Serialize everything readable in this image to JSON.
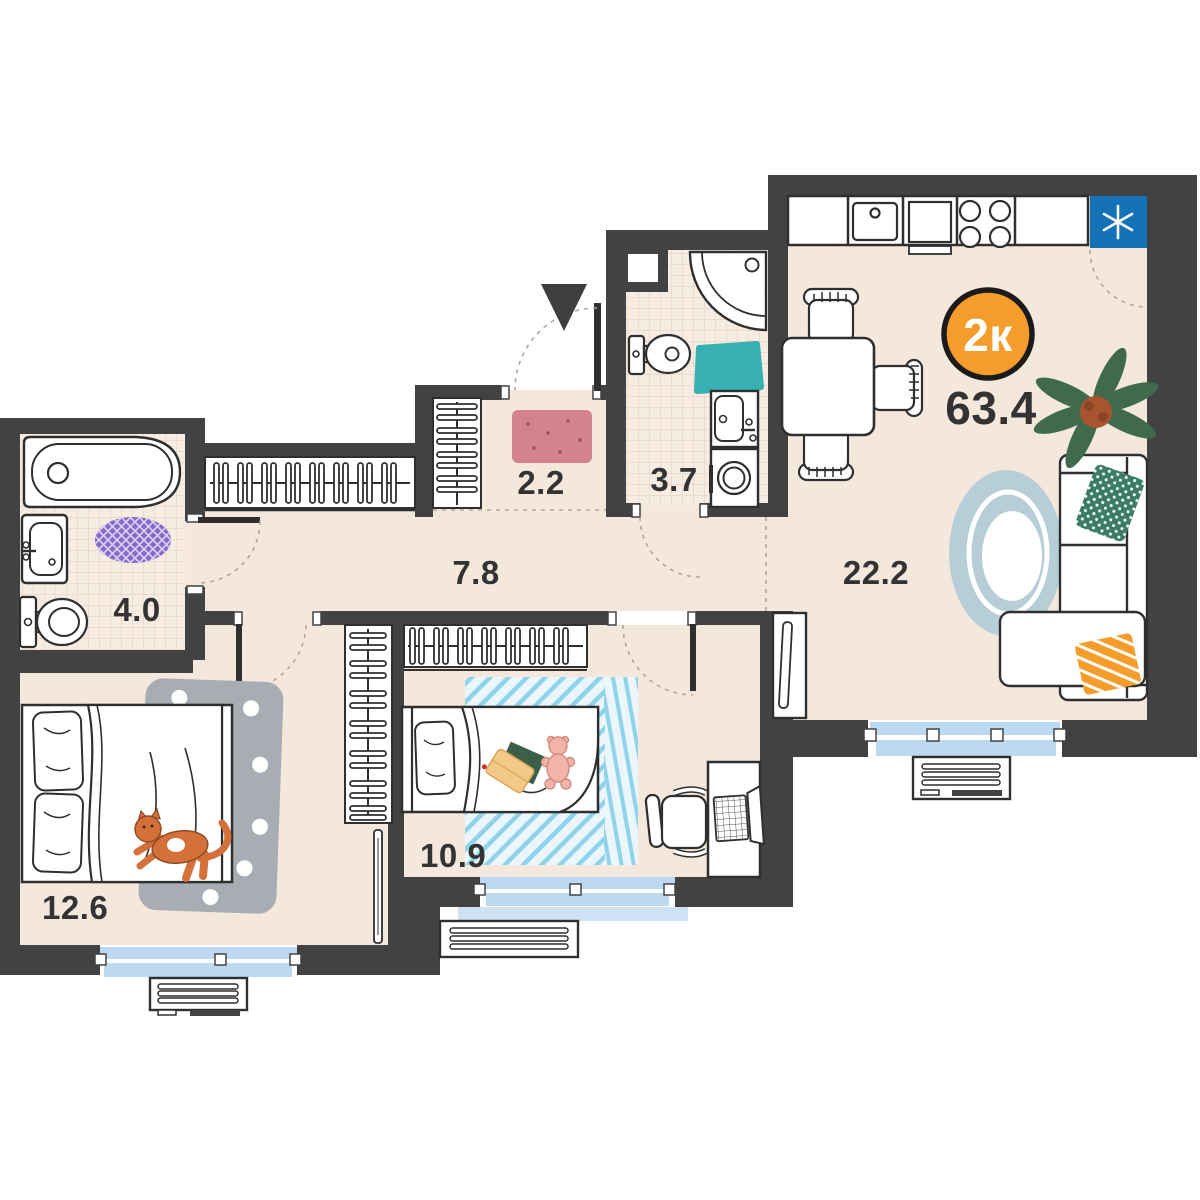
{
  "floor_plan": {
    "unit_badge": {
      "label": "2к",
      "color": "#f59d2c"
    },
    "total_area": "63.4",
    "rooms": {
      "kitchen_living": {
        "area": "22.2"
      },
      "corridor": {
        "area": "7.8"
      },
      "entry_hall": {
        "area": "2.2"
      },
      "wc": {
        "area": "3.7"
      },
      "bathroom": {
        "area": "4.0"
      },
      "bedroom": {
        "area": "12.6"
      },
      "kids_room": {
        "area": "10.9"
      }
    },
    "colors": {
      "wall": "#424242",
      "floor": "#f4e8dc",
      "tile_floor": "#f7ece2",
      "tile_line": "#e2d2c2",
      "window_blue": "#bdd9f2",
      "fridge_blue": "#1472b7",
      "badge_orange": "#f59d2c",
      "rug_pink": "#d4828f",
      "rug_purple": "#8a68c8",
      "rug_teal": "#36b0b2",
      "rug_blue": "#b7ced9",
      "rug_gray": "#a7adb2",
      "rug_stripe_blue": "#8fd3ea",
      "pillow_green": "#3b7c68",
      "pillow_orange": "#f49d2b",
      "plant_green": "#3f6b4c",
      "cat_orange": "#d4713a",
      "outline": "#2f2f2f"
    },
    "icons": [
      "entrance-arrow-icon",
      "snowflake-icon",
      "bathtub-icon",
      "sink-icon",
      "toilet-icon",
      "corner-shower-icon",
      "washing-machine-icon",
      "wardrobe-icon",
      "double-bed-icon",
      "single-bed-icon",
      "cat-icon",
      "teddy-bear-icon",
      "book-icon",
      "desk-icon",
      "laptop-icon",
      "office-chair-icon",
      "dining-table-icon",
      "corner-sofa-icon",
      "plant-icon",
      "rug-icon",
      "air-conditioner-icon",
      "tv-stand-icon",
      "window-icon",
      "door-swing-icon"
    ]
  }
}
